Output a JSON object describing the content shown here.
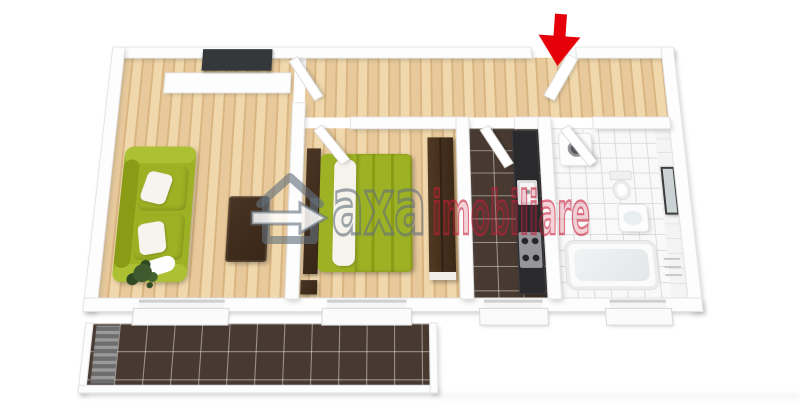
{
  "scene": {
    "title": "3D apartment floor plan render",
    "watermark": {
      "logo": "house-arrow-icon",
      "brand_gray": "axa",
      "brand_red": "imobiliare"
    },
    "entrance": {
      "marker": "red-down-arrow"
    },
    "rooms": [
      {
        "name": "living-room",
        "floor": "wood",
        "furniture": [
          "sofa",
          "coffee-table",
          "tv-panel",
          "sideboard",
          "plant"
        ]
      },
      {
        "name": "hallway",
        "floor": "wood",
        "furniture": [
          "entrance-door"
        ]
      },
      {
        "name": "bedroom",
        "floor": "wood",
        "furniture": [
          "double-bed",
          "headboard",
          "nightstand",
          "wardrobe"
        ]
      },
      {
        "name": "kitchen",
        "floor": "dark-tile",
        "furniture": [
          "counter",
          "sink",
          "stove"
        ]
      },
      {
        "name": "bathroom",
        "floor": "white-tile",
        "furniture": [
          "washing-machine",
          "toilet",
          "sink",
          "mirror",
          "bathtub",
          "towel-rail"
        ]
      },
      {
        "name": "balcony",
        "floor": "dark-tile",
        "furniture": [
          "striped-mat"
        ]
      }
    ],
    "colors": {
      "wall": "#fdfdfd",
      "wall_edge": "#e4e4e4",
      "wall_shadow": "rgba(90,90,90,0.28)",
      "wood_base": "#e7c99b",
      "wood_stripe": "#d9b582",
      "wood_light": "#f0d8ac",
      "tile_dark": "#483a31",
      "tile_grout": "rgba(255,255,255,0.45)",
      "bath_tile": "#f9f9f9",
      "bath_grout": "#dcdcdc",
      "sofa_green": "#9cb123",
      "sofa_green_light": "#abc133",
      "green_dark": "#8a9c15",
      "wood_furniture": "#4a3423",
      "wood_furniture_dark": "#382617",
      "counter": "#2a2a2d",
      "steel": "#95959a",
      "arrow_red": "#e60009",
      "plant_green": "#3e5a2e",
      "wm_gray": "rgba(100,113,124,0.62)",
      "wm_red": "rgba(203,30,58,0.58)",
      "wm_red_fill": "rgba(203,30,58,0.18)"
    }
  }
}
